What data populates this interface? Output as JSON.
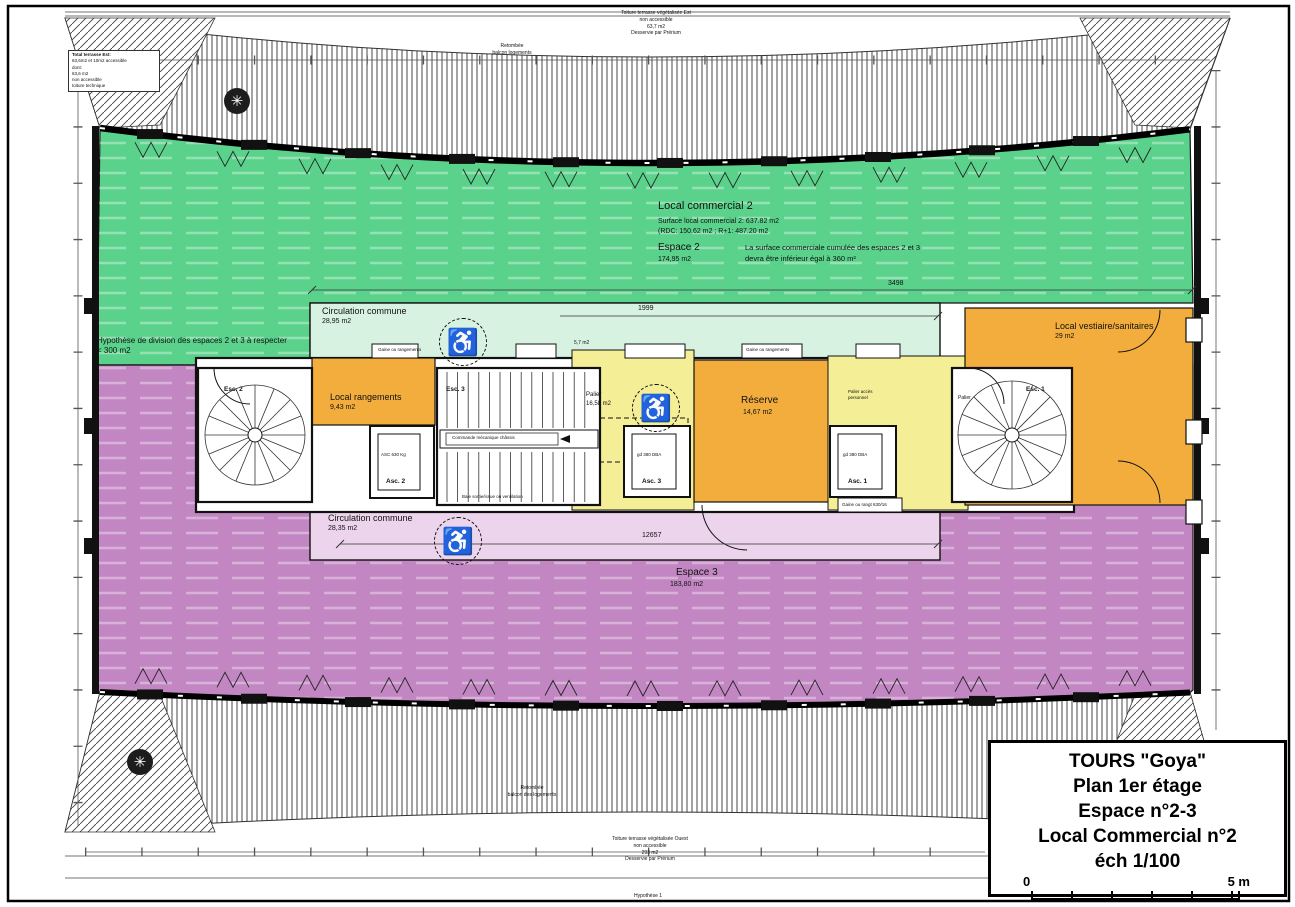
{
  "colors": {
    "green": "#5bd28c",
    "green_light": "#d8f2e2",
    "purple": "#c287c3",
    "purple_light": "#ecd4ec",
    "orange": "#f2ad3d",
    "yellow": "#f4ee96",
    "wall": "#111111"
  },
  "icons": {
    "wheelchair": "♿",
    "tree": "✳"
  },
  "title_block": {
    "lines": [
      "TOURS \"Goya\"",
      "Plan 1er étage",
      "Espace n°2-3",
      "Local Commercial n°2",
      "éch 1/100"
    ],
    "scale_start": "0",
    "scale_end": "5 m"
  },
  "zones": {
    "local_commercial_2": {
      "title": "Local commercial 2",
      "line1": "Surface local commercial 2: 637.82 m2",
      "line2": "(RDC: 150.62 m2 ; R+1: 487.20 m2",
      "espace2_label": "Espace 2",
      "espace2_area": "174,95 m2",
      "note_line1": "La surface commerciale cumulée des espaces 2 et 3",
      "note_line2": "devra être inférieur égal à 360 m²"
    },
    "hypothese": {
      "line1": "Hypothèse de division des espaces 2 et 3 à respecter",
      "line2": "< 300 m2"
    },
    "circulation_top": {
      "title": "Circulation commune",
      "area": "28,95 m2"
    },
    "circulation_bottom": {
      "title": "Circulation commune",
      "area": "28,35 m2"
    },
    "local_rangements": {
      "title": "Local rangements",
      "area": "9,43 m2"
    },
    "reserve": {
      "title": "Réserve",
      "area": "14,67 m2"
    },
    "vestiaire": {
      "title": "Local vestiaire/sanitaires",
      "area": "29 m2"
    },
    "espace3": {
      "title": "Espace 3",
      "area": "183,80 m2"
    }
  },
  "core": {
    "esc1": "Esc. 1",
    "esc2": "Esc. 2",
    "esc3": "Esc. 3",
    "asc1": "Asc. 1",
    "asc2": "Asc. 2",
    "asc3": "Asc. 3",
    "asc2_note": "ASC 630 Kg",
    "asc1_note": "gd 380 DBA",
    "asc3_note": "gd 380 DBA",
    "palier_label": "Palier",
    "palier_area": "16,58 m2",
    "palier_small": "5,7 m2",
    "palier_right": "Palier",
    "palier_access_l1": "Palier accès",
    "palier_access_l2": "personnel",
    "gaine1": "Gaine ou rangements",
    "gaine2": "Gaine ou rangements",
    "gaine3": "Gaine ou rangt 630/16",
    "stair_note": "Commande mécanique châssis",
    "exit_note": "Baie sortie/issue ou ventilation"
  },
  "annotations": {
    "top_note_l1": "Toiture terrasse végétalisée Est",
    "top_note_l2": "non accessible",
    "top_note_l3": "63,7 m2",
    "top_note_l4": "Desservie par Prérium",
    "bottom_note_l1": "Toiture terrasse végétalisée Ouest",
    "bottom_note_l2": "non accessible",
    "bottom_note_l3": "293 m2",
    "bottom_note_l4": "Desservie par Prérium",
    "retombee_top_l1": "Retombée",
    "retombee_top_l2": "balcon logements",
    "retombee_bottom_l1": "Retombée",
    "retombee_bottom_l2": "balcon des logements",
    "terrasse_est_l1": "Total terrasse Est:",
    "terrasse_est_l2": "63,6m2 et 10m2 accessible",
    "terrasse_est_l3": "dont:",
    "terrasse_est_l4": "63,6 m2",
    "terrasse_est_l5": "non accessible",
    "terrasse_est_l6": "toiture technique",
    "hypothese_bottom": "Hypothèse 1"
  },
  "dimensions": {
    "d_top": "3498",
    "d_mid": "1999",
    "d_bottom": "12657"
  }
}
